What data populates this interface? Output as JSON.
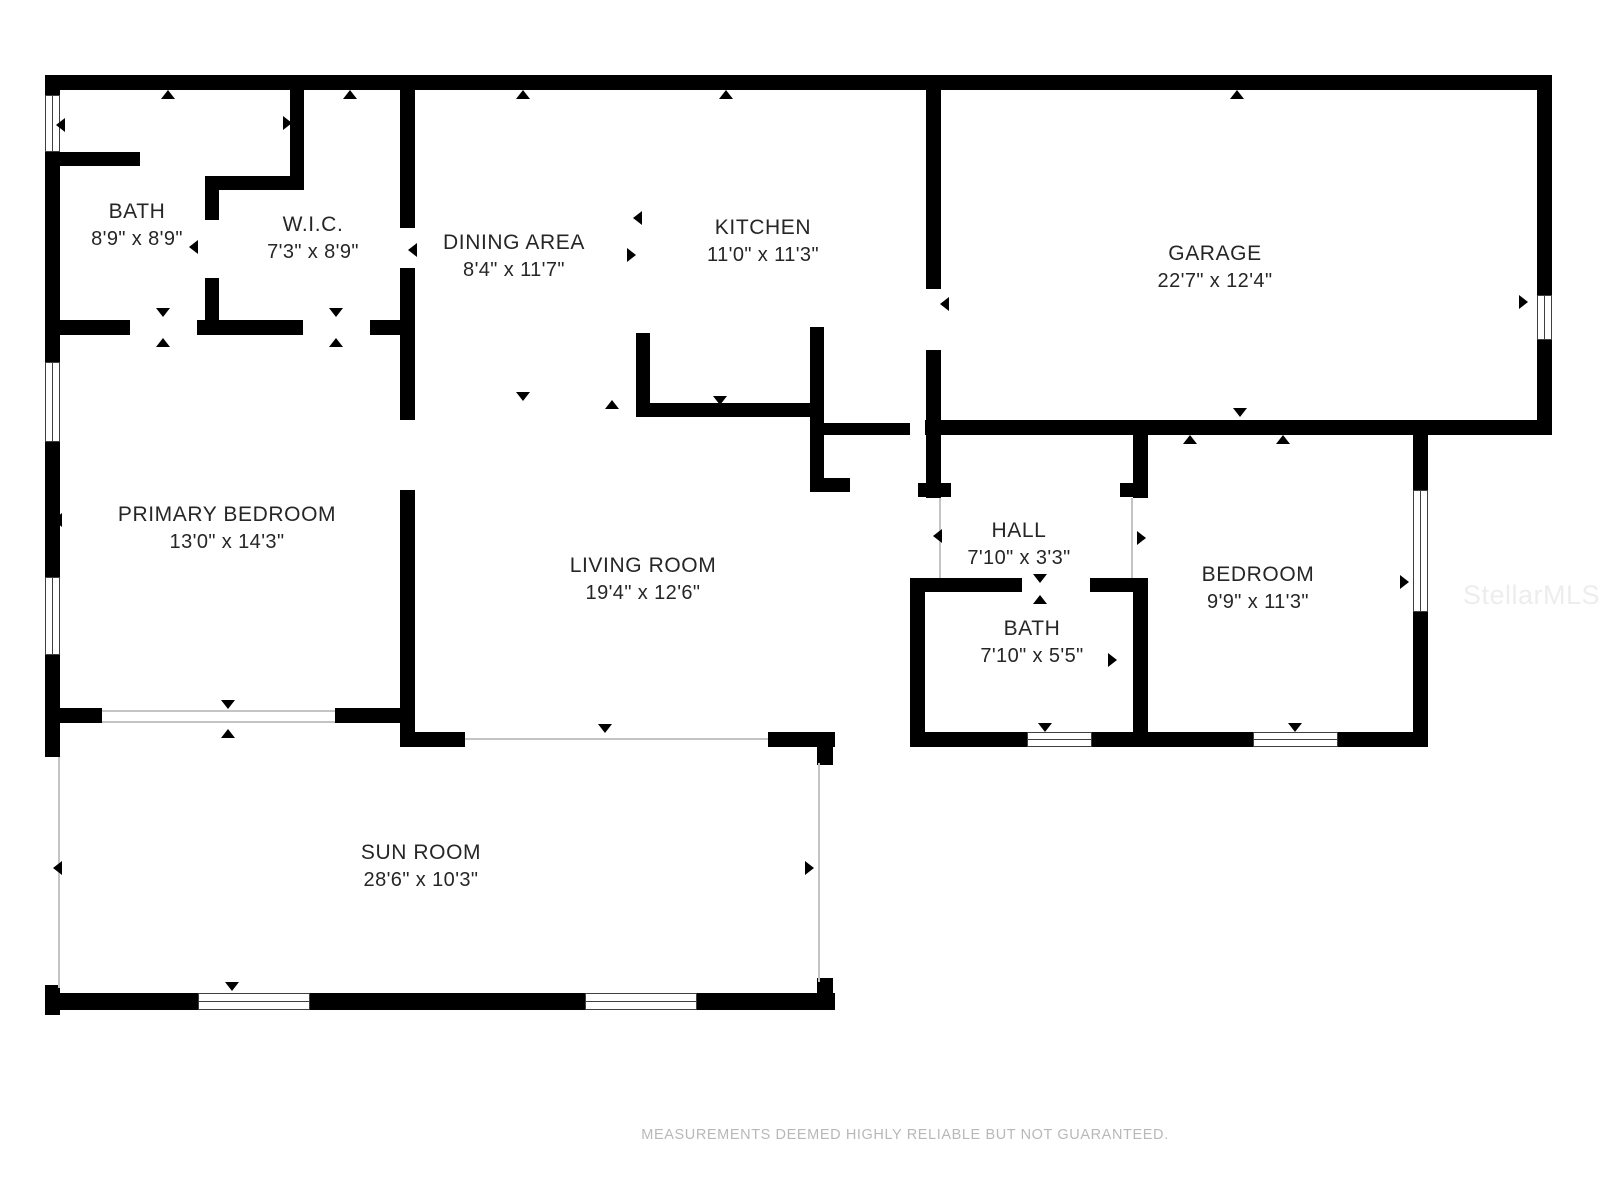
{
  "page": {
    "footer": "MEASUREMENTS DEEMED HIGHLY RELIABLE BUT NOT GUARANTEED.",
    "watermark": "StellarMLS"
  },
  "colors": {
    "wall": "#000000",
    "thin_wall": "#c4c4c4",
    "window_frame": "#3f3f3f",
    "label": "#262626",
    "footer_text": "#b8b8b8",
    "watermark_text": "#ededed",
    "background": "#ffffff"
  },
  "rooms": [
    {
      "name": "BATH",
      "dims": "8'9\" x 8'9\"",
      "cx": 137,
      "cy": 225
    },
    {
      "name": "W.I.C.",
      "dims": "7'3\" x 8'9\"",
      "cx": 313,
      "cy": 238
    },
    {
      "name": "DINING AREA",
      "dims": "8'4\" x 11'7\"",
      "cx": 514,
      "cy": 256
    },
    {
      "name": "KITCHEN",
      "dims": "11'0\" x 11'3\"",
      "cx": 763,
      "cy": 241
    },
    {
      "name": "GARAGE",
      "dims": "22'7\" x 12'4\"",
      "cx": 1215,
      "cy": 267
    },
    {
      "name": "PRIMARY BEDROOM",
      "dims": "13'0\" x 14'3\"",
      "cx": 227,
      "cy": 528
    },
    {
      "name": "LIVING ROOM",
      "dims": "19'4\" x 12'6\"",
      "cx": 643,
      "cy": 579
    },
    {
      "name": "HALL",
      "dims": "7'10\" x 3'3\"",
      "cx": 1019,
      "cy": 544
    },
    {
      "name": "BATH",
      "dims": "7'10\" x 5'5\"",
      "cx": 1032,
      "cy": 642
    },
    {
      "name": "BEDROOM",
      "dims": "9'9\" x 11'3\"",
      "cx": 1258,
      "cy": 588
    },
    {
      "name": "SUN ROOM",
      "dims": "28'6\" x 10'3\"",
      "cx": 421,
      "cy": 866
    }
  ],
  "floorplan": {
    "walls": [
      [
        45,
        75,
        1507,
        15
      ],
      [
        45,
        90,
        15,
        667
      ],
      [
        1537,
        90,
        15,
        343
      ],
      [
        925,
        420,
        627,
        15
      ],
      [
        820,
        423,
        90,
        12
      ],
      [
        60,
        152,
        80,
        14
      ],
      [
        290,
        90,
        14,
        100
      ],
      [
        205,
        176,
        99,
        14
      ],
      [
        205,
        190,
        14,
        30
      ],
      [
        205,
        278,
        14,
        56
      ],
      [
        45,
        320,
        85,
        15
      ],
      [
        197,
        320,
        106,
        15
      ],
      [
        370,
        320,
        45,
        15
      ],
      [
        400,
        90,
        15,
        138
      ],
      [
        400,
        268,
        15,
        152
      ],
      [
        400,
        490,
        15,
        257
      ],
      [
        45,
        708,
        57,
        15
      ],
      [
        335,
        708,
        80,
        15
      ],
      [
        400,
        732,
        65,
        15
      ],
      [
        768,
        732,
        67,
        15
      ],
      [
        817,
        747,
        16,
        18
      ],
      [
        636,
        333,
        14,
        84
      ],
      [
        636,
        403,
        188,
        14
      ],
      [
        810,
        327,
        14,
        163
      ],
      [
        810,
        478,
        40,
        14
      ],
      [
        926,
        90,
        15,
        199
      ],
      [
        926,
        350,
        15,
        148
      ],
      [
        918,
        483,
        33,
        14
      ],
      [
        1133,
        433,
        15,
        65
      ],
      [
        1120,
        483,
        13,
        14
      ],
      [
        1133,
        578,
        15,
        169
      ],
      [
        910,
        578,
        15,
        169
      ],
      [
        925,
        578,
        97,
        14
      ],
      [
        1090,
        578,
        55,
        14
      ],
      [
        910,
        732,
        117,
        15
      ],
      [
        1092,
        732,
        60,
        15
      ],
      [
        1148,
        732,
        105,
        15
      ],
      [
        1338,
        732,
        90,
        15
      ],
      [
        1413,
        433,
        15,
        314
      ],
      [
        45,
        985,
        15,
        30
      ],
      [
        45,
        993,
        790,
        17
      ],
      [
        817,
        978,
        16,
        32
      ]
    ],
    "thin_walls": [
      [
        58,
        757,
        2,
        231
      ],
      [
        818,
        763,
        2,
        219
      ],
      [
        102,
        710,
        233,
        2
      ],
      [
        102,
        721,
        233,
        2
      ],
      [
        465,
        738,
        303,
        2
      ],
      [
        939,
        498,
        2,
        80
      ],
      [
        1131,
        498,
        2,
        80
      ]
    ],
    "windows": [
      {
        "x": 45,
        "y": 95,
        "w": 15,
        "h": 57,
        "o": "v"
      },
      {
        "x": 45,
        "y": 362,
        "w": 15,
        "h": 80,
        "o": "v"
      },
      {
        "x": 45,
        "y": 577,
        "w": 15,
        "h": 78,
        "o": "v"
      },
      {
        "x": 198,
        "y": 993,
        "w": 112,
        "h": 17,
        "o": "h"
      },
      {
        "x": 585,
        "y": 993,
        "w": 112,
        "h": 17,
        "o": "h"
      },
      {
        "x": 1027,
        "y": 732,
        "w": 65,
        "h": 15,
        "o": "h"
      },
      {
        "x": 1253,
        "y": 732,
        "w": 85,
        "h": 15,
        "o": "h"
      },
      {
        "x": 1413,
        "y": 490,
        "w": 15,
        "h": 122,
        "o": "v"
      },
      {
        "x": 1537,
        "y": 295,
        "w": 15,
        "h": 45,
        "o": "v"
      }
    ],
    "markers": [
      {
        "x": 168,
        "y": 94,
        "d": "up"
      },
      {
        "x": 350,
        "y": 94,
        "d": "up"
      },
      {
        "x": 523,
        "y": 94,
        "d": "up"
      },
      {
        "x": 726,
        "y": 94,
        "d": "up"
      },
      {
        "x": 1237,
        "y": 94,
        "d": "up"
      },
      {
        "x": 163,
        "y": 342,
        "d": "up"
      },
      {
        "x": 336,
        "y": 342,
        "d": "up"
      },
      {
        "x": 228,
        "y": 733,
        "d": "up"
      },
      {
        "x": 612,
        "y": 404,
        "d": "up"
      },
      {
        "x": 1283,
        "y": 439,
        "d": "up"
      },
      {
        "x": 1190,
        "y": 439,
        "d": "up"
      },
      {
        "x": 1040,
        "y": 599,
        "d": "up"
      },
      {
        "x": 163,
        "y": 313,
        "d": "down"
      },
      {
        "x": 336,
        "y": 313,
        "d": "down"
      },
      {
        "x": 228,
        "y": 705,
        "d": "down"
      },
      {
        "x": 523,
        "y": 397,
        "d": "down"
      },
      {
        "x": 605,
        "y": 729,
        "d": "down"
      },
      {
        "x": 720,
        "y": 401,
        "d": "down"
      },
      {
        "x": 1240,
        "y": 413,
        "d": "down"
      },
      {
        "x": 1040,
        "y": 579,
        "d": "down"
      },
      {
        "x": 1045,
        "y": 728,
        "d": "down"
      },
      {
        "x": 1295,
        "y": 728,
        "d": "down"
      },
      {
        "x": 232,
        "y": 987,
        "d": "down"
      },
      {
        "x": 60,
        "y": 125,
        "d": "left"
      },
      {
        "x": 57,
        "y": 520,
        "d": "left"
      },
      {
        "x": 57,
        "y": 868,
        "d": "left"
      },
      {
        "x": 193,
        "y": 247,
        "d": "left"
      },
      {
        "x": 412,
        "y": 250,
        "d": "left"
      },
      {
        "x": 637,
        "y": 218,
        "d": "left"
      },
      {
        "x": 944,
        "y": 304,
        "d": "left"
      },
      {
        "x": 937,
        "y": 536,
        "d": "left"
      },
      {
        "x": 917,
        "y": 633,
        "d": "left"
      },
      {
        "x": 288,
        "y": 123,
        "d": "right"
      },
      {
        "x": 405,
        "y": 498,
        "d": "right"
      },
      {
        "x": 632,
        "y": 255,
        "d": "right"
      },
      {
        "x": 1142,
        "y": 538,
        "d": "right"
      },
      {
        "x": 1113,
        "y": 660,
        "d": "right"
      },
      {
        "x": 1405,
        "y": 582,
        "d": "right"
      },
      {
        "x": 810,
        "y": 868,
        "d": "right"
      },
      {
        "x": 1524,
        "y": 302,
        "d": "right"
      }
    ]
  }
}
